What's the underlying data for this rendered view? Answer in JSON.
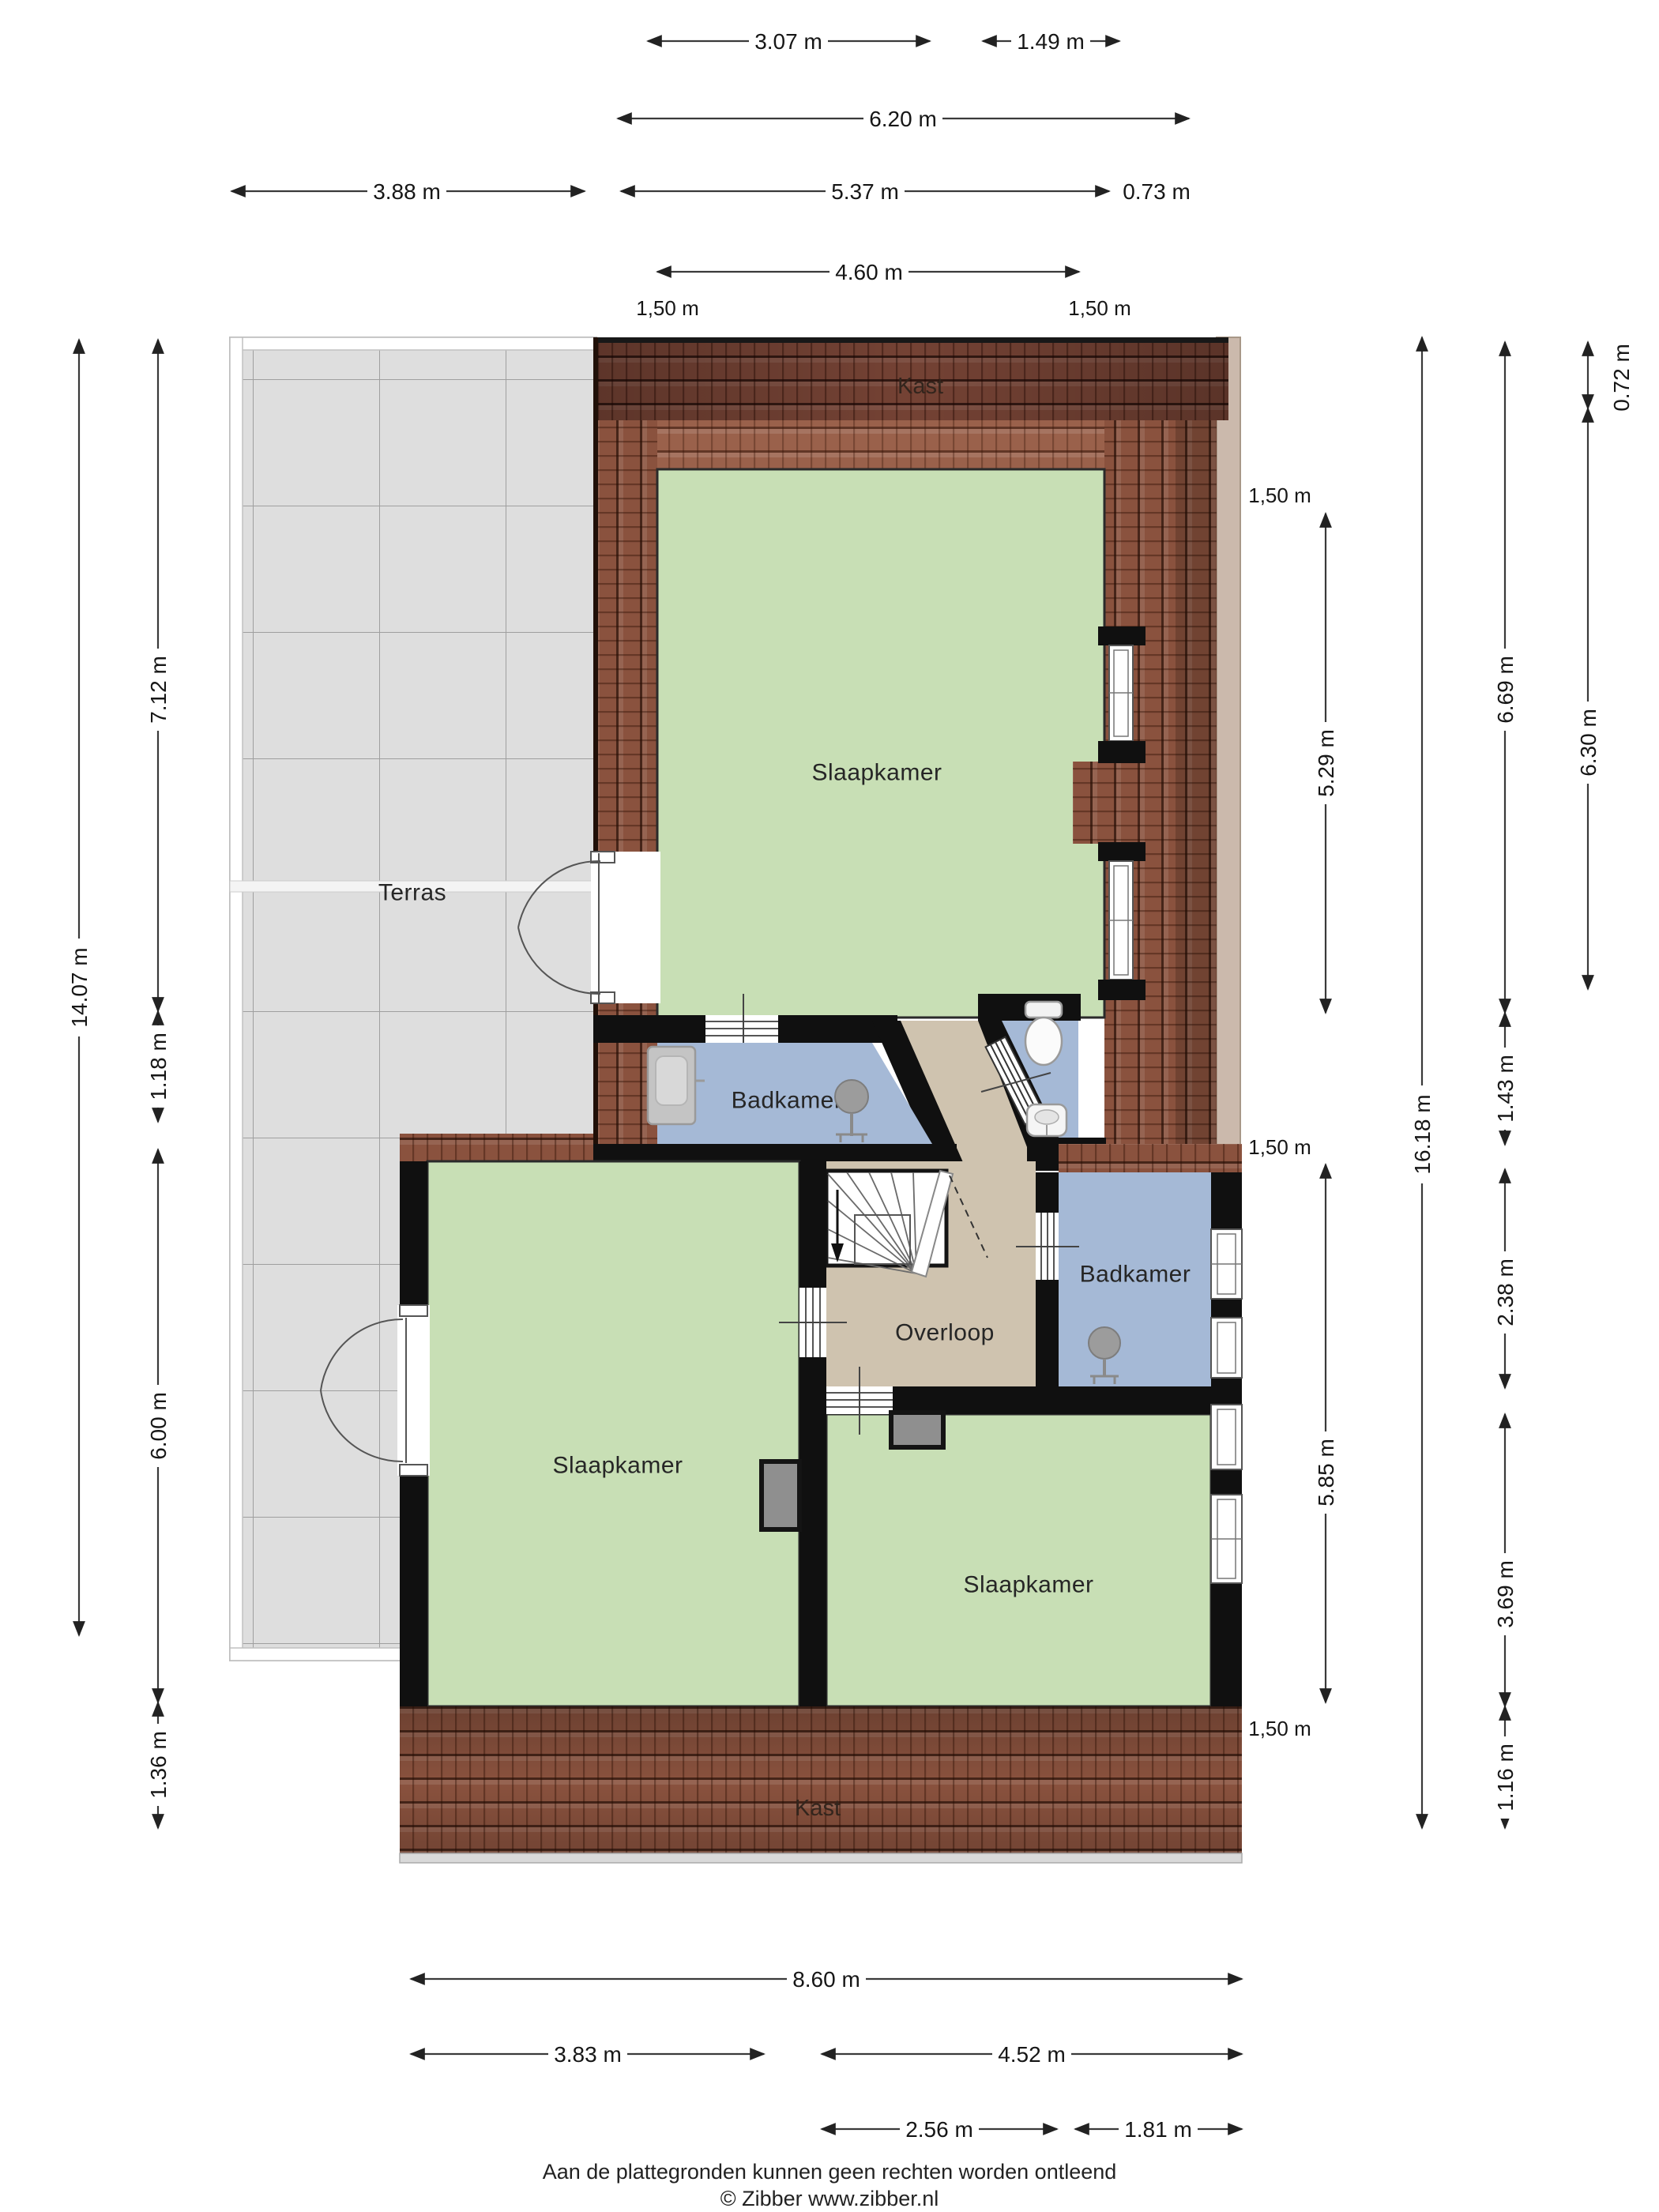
{
  "title": "Verdieping plattegrond",
  "rooms": {
    "kast_top": "Kast",
    "slaapkamer_top": "Slaapkamer",
    "terras": "Terras",
    "badkamer_left": "Badkamer",
    "overloop": "Overloop",
    "badkamer_right": "Badkamer",
    "slaapkamer_left": "Slaapkamer",
    "slaapkamer_right": "Slaapkamer",
    "kast_bottom": "Kast"
  },
  "dimensions": {
    "top": [
      "3.07 m",
      "1.49 m",
      "6.20 m",
      "3.88 m",
      "5.37 m",
      "0.73 m",
      "4.60 m",
      "1,50 m",
      "1,50 m"
    ],
    "left": [
      "14.07 m",
      "7.12 m",
      "1.18 m",
      "6.00 m",
      "1.36 m"
    ],
    "right": [
      "16.18 m",
      "6.69 m",
      "1.43 m",
      "2.38 m",
      "3.69 m",
      "1.16 m",
      "0.72 m",
      "6.30 m"
    ],
    "right_inner": [
      "1,50 m",
      "5.29 m",
      "1,50 m",
      "5.85 m",
      "1,50 m"
    ],
    "bottom": [
      "8.60 m",
      "3.83 m",
      "4.52 m",
      "2.56 m",
      "1.81 m"
    ]
  },
  "footer": {
    "disclaimer": "Aan de plattegronden kunnen geen rechten worden ontleend",
    "credit": "© Zibber www.zibber.nl"
  },
  "colors": {
    "wall": "#101010",
    "bedroom_green": "#c8dfb5",
    "bathroom_blue": "#a5b9d6",
    "hallway_tan": "#cfc3af",
    "roof_tile_mid": "#8a523e",
    "roof_tile_dark": "#744234",
    "roof_tile_light": "#9a614b",
    "terrace_gray": "#dedede"
  }
}
